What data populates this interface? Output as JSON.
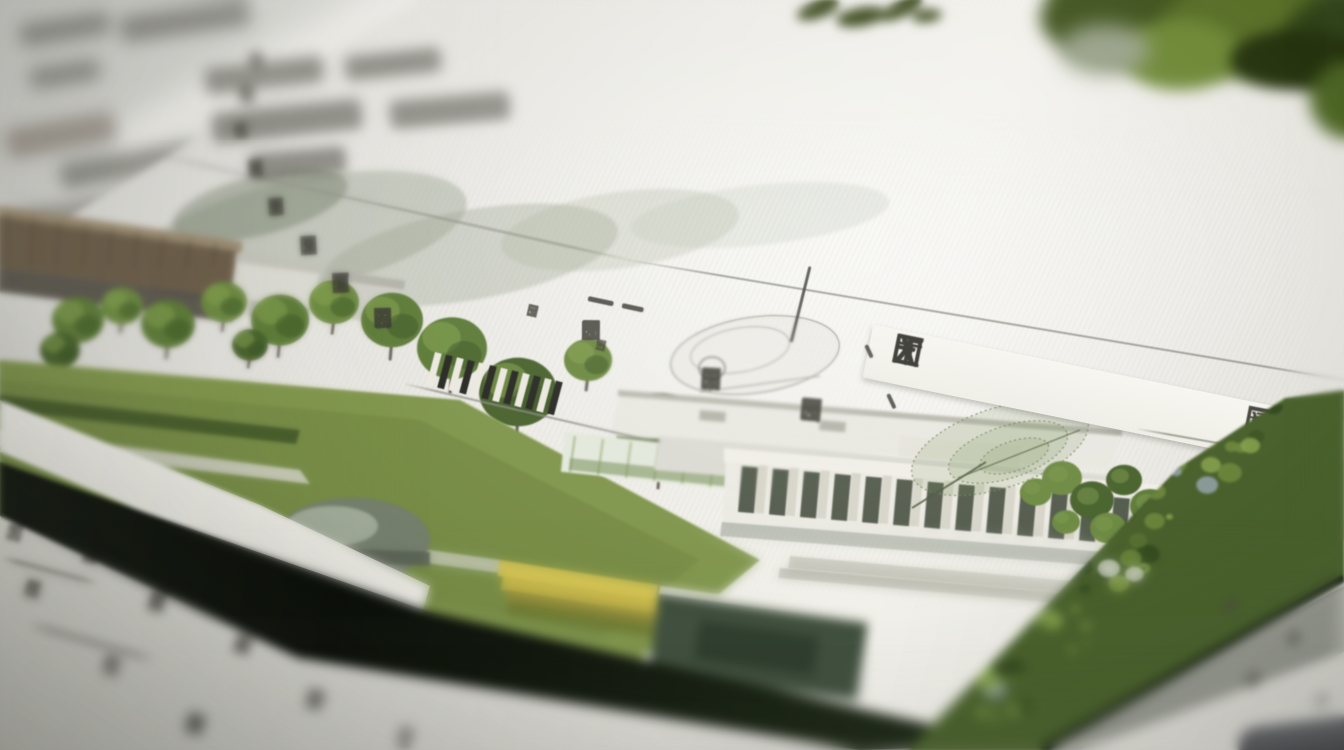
{
  "scene": {
    "type": "macro photograph",
    "label": "Close-up photo of a printed landscape-architecture report page lying on other papers; dense illegible CJK-style printed text above a green campus site rendering; shallow depth of field",
    "legibility_note": "all printed characters are illegible glyph noise"
  },
  "palette": {
    "paper": "#efeee8",
    "paper_dim": "#d8d8d2",
    "ink": "#3a3a32",
    "ink_soft": "#4a4a42",
    "rule": "#8e8e85",
    "foliage_dark": "#3c4a1d",
    "canopy": "#5f7c3a",
    "canopy_mid": "#6d8a42",
    "canopy_deep": "#49632e",
    "lawn": "#81964d",
    "lawn_deep": "#6d8340",
    "roof_brown": "#6d5f4b",
    "wall": "#ecebe3",
    "window_dark": "#474f41",
    "page_edge": "#101509",
    "yellow_pavilion": "#c4b54a",
    "teal_shed": "#41503f",
    "aerial_green": "#49602c",
    "corner_object": "#515257",
    "sketch_gray": "#97a08c"
  },
  "main_page": {
    "label": "in-focus printed report page with pseudo-CJK body text, a bold emphasis row, thin rules and an illustrated site-plan band",
    "body_rows": [
      {
        "pattern": "8 6 9 5 7 8 6 9 5 7"
      },
      {
        "pattern": "7 5 8 6 9 4 8 7 8"
      },
      {
        "pattern": "6 8 5 9 7 6 8 5 6"
      },
      {
        "pattern": "7 4 8 6 5 9 6 6 5"
      },
      {
        "pattern": "5 7 6 8 4 7 6 9"
      },
      {
        "pattern": "6 5 7 4 8 6 7 5"
      },
      {
        "pattern": "5 8 4 7 6 5 9"
      },
      {
        "pattern": "7 5 6 8 4 6 4"
      },
      {
        "pattern": "5 4 6 3 7 6"
      },
      {
        "pattern": "4 6 3 7 4"
      },
      {
        "pattern": "5 3 6 5"
      }
    ],
    "emphasis_row": {
      "pattern": "2 3 2 2",
      "style": "bold-large"
    },
    "emphasis_tail": {
      "pattern": "3",
      "style": "bold-small"
    },
    "captions": [
      {
        "pattern": "3 2 4"
      },
      {
        "pattern": "2 3"
      }
    ],
    "header_blocks_label": "blurred heavy glyph clusters at top-left of the text block",
    "rules_label": "thin printed rules running diagonally with page perspective",
    "emphasis_strip_label": "bright paper strip behind the bold row"
  },
  "background": {
    "papers_label": "out-of-focus stacked white papers, top-left",
    "foliage_label": "out-of-focus green foliage overhanging the top-right corner",
    "sprig_label": "small dark-green leaf sprig at the top edge"
  },
  "underlying_pages": {
    "bottom_left_label": "underlying page with illegible print and short rules, partly in focus",
    "bottom_left_rows": [
      {
        "pattern": "2 3"
      },
      {
        "pattern": "4 2 3"
      },
      {
        "pattern": "3 2 2"
      },
      {
        "pattern": "2 4 3 2"
      },
      {
        "pattern": "3 3"
      },
      {
        "pattern": "2 2"
      },
      {
        "pattern": "3 2"
      },
      {
        "pattern": "2 3 2"
      },
      {
        "pattern": "2"
      }
    ],
    "bottom_right_label": "underlying page corner with blurred print and a dark rounded object",
    "bottom_right_rows": [
      {
        "pattern": "2 3"
      },
      {
        "pattern": "3 2"
      },
      {
        "pattern": "2 2"
      },
      {
        "pattern": "2"
      }
    ]
  },
  "illustration": {
    "label": "printed site rendering: heritage buildings, tree rows, lawns, a classical colonnaded building, sketched foliage, and a tree-canopy band bleeding off the page edge",
    "elements": [
      {
        "name": "sketch-trees",
        "label": "stippled gray-green sketch trees"
      },
      {
        "name": "heritage-building",
        "label": "brown-roofed traditional building"
      },
      {
        "name": "tree-row",
        "label": "row of round green trees"
      },
      {
        "name": "lawn",
        "label": "green lawn with light paths"
      },
      {
        "name": "dome-structure",
        "label": "gray domed structure"
      },
      {
        "name": "yellow-pavilion",
        "label": "layered yellow pavilion"
      },
      {
        "name": "dark-shed",
        "label": "dark green-gray shed"
      },
      {
        "name": "greenhouse",
        "label": "pale greenhouse strip"
      },
      {
        "name": "rock-sketch",
        "label": "pencil rock sketch"
      },
      {
        "name": "keyboard-hatch",
        "label": "striped hatch element"
      },
      {
        "name": "roof-planes",
        "label": "large pale roof planes"
      },
      {
        "name": "classical-building",
        "label": "white colonnaded building with dark windows"
      },
      {
        "name": "courtyard-trees",
        "label": "courtyard tree cluster"
      },
      {
        "name": "leaf-sketch",
        "label": "stippled leaf line-drawing"
      },
      {
        "name": "aerial-band",
        "label": "dense aerial tree canopy band along the page edge"
      }
    ]
  }
}
